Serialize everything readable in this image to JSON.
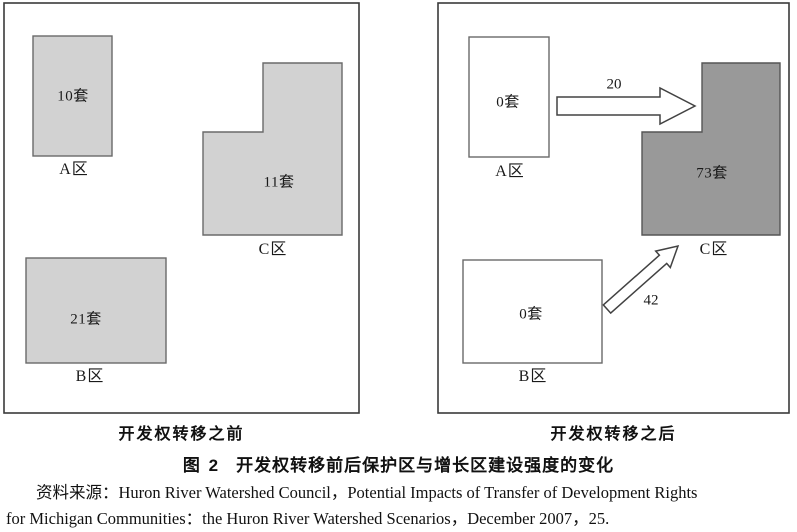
{
  "panels": {
    "before": {
      "caption": "开发权转移之前",
      "zones": {
        "a": {
          "units": "10套",
          "label": "A区"
        },
        "b": {
          "units": "21套",
          "label": "B区"
        },
        "c": {
          "units": "11套",
          "label": "C区"
        }
      }
    },
    "after": {
      "caption": "开发权转移之后",
      "zones": {
        "a": {
          "units": "0套",
          "label": "A区"
        },
        "b": {
          "units": "0套",
          "label": "B区"
        },
        "c": {
          "units": "73套",
          "label": "C区"
        }
      },
      "transfers": {
        "a_to_c": "20",
        "b_to_c": "42"
      }
    }
  },
  "caption": {
    "figure_label": "图 2",
    "title": "开发权转移前后保护区与增长区建设强度的变化"
  },
  "source": {
    "line1": "资料来源：Huron River Watershed Council，Potential Impacts of Transfer of Development Rights",
    "line2": "for Michigan Communities：the Huron River Watershed Scenarios，December 2007，25."
  },
  "colors": {
    "light_fill": "#d2d2d2",
    "dark_fill": "#999999",
    "white_fill": "#ffffff",
    "shape_stroke": "#6a6a6a",
    "arrow_stroke": "#424242",
    "panel_border": "#3a3a3a"
  }
}
